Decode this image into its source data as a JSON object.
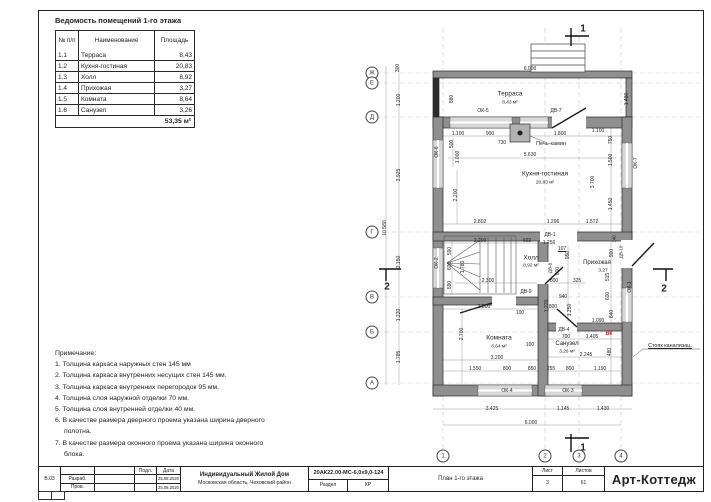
{
  "room_table": {
    "title": "Ведомость помещений 1-го этажа",
    "headers": [
      "№ п/п",
      "Наименование",
      "Площадь"
    ],
    "rows": [
      [
        "1.1",
        "Терраса",
        "8,43"
      ],
      [
        "1.2",
        "Кухня-гостиная",
        "20,83"
      ],
      [
        "1.3",
        "Холл",
        "8,92"
      ],
      [
        "1.4",
        "Прихожая",
        "3,27"
      ],
      [
        "1.5",
        "Комната",
        "8,64"
      ],
      [
        "1.6",
        "Санузел",
        "3,26"
      ]
    ],
    "total": "53,35 м²"
  },
  "notes": {
    "title": "Примечание:",
    "items": [
      "1. Толщина каркаса наружных стен 145 мм",
      "2. Толщина каркаса внутренних несущих стен 145 мм.",
      "3. Толщина каркаса внутренних перегородок 95 мм.",
      "4. Толщина слоя наружной отделки 70 мм.",
      "5. Толщина слоя внутренней отделки 40 мм.",
      "6. В качестве размера дверного проема указана ширина дверного полотна.",
      "7. В качестве размера оконного проема указана ширина оконного блока."
    ]
  },
  "title_block": {
    "rev": "В.03",
    "razrab_label": "Разраб.",
    "prov_label": "Пров.",
    "podl_label": "Подл.",
    "date_label": "Дата",
    "date1": "25.08.2020",
    "date2": "25.08.2020",
    "project": "Индивидуальный Жилой Дом",
    "location": "Московская область, Чеховский район",
    "doc_code": "20АК22.00-МС-6,0х9,0-124",
    "razdel_label": "Раздел",
    "razdel_value": "КР",
    "sheet_name": "План 1-го этажа",
    "sheet_label": "Лист",
    "sheets_label": "Листов",
    "sheet_num": "3",
    "sheets_total": "61",
    "company": "Арт-Коттедж"
  },
  "plan": {
    "accent_red": "#cc2222",
    "axis_bubbles_bottom": [
      {
        "label": "1",
        "x": 443
      },
      {
        "label": "2",
        "x": 545
      },
      {
        "label": "3",
        "x": 579
      },
      {
        "label": "4",
        "x": 621
      }
    ],
    "axis_bubbles_left": [
      {
        "label": "Ж",
        "y": 73
      },
      {
        "label": "Е",
        "y": 83
      },
      {
        "label": "Д",
        "y": 117
      },
      {
        "label": "Г",
        "y": 232
      },
      {
        "label": "В",
        "y": 297
      },
      {
        "label": "Б",
        "y": 332
      },
      {
        "label": "А",
        "y": 383
      }
    ],
    "labels": [
      {
        "t": "6.000",
        "x": 530,
        "y": 69
      },
      {
        "t": "1.480",
        "x": 627,
        "y": 99,
        "r": -90
      },
      {
        "t": "880",
        "x": 452,
        "y": 99,
        "r": -90
      },
      {
        "t": "Терраса",
        "x": 510,
        "y": 94,
        "s": 6.5,
        "n": "room-label"
      },
      {
        "t": "8,43 м²",
        "x": 510,
        "y": 103,
        "s": 4.8,
        "n": "room-area"
      },
      {
        "t": "ОК-5",
        "x": 483,
        "y": 111,
        "n": "opening-mark"
      },
      {
        "t": "ДВ-7",
        "x": 556,
        "y": 111,
        "n": "opening-mark"
      },
      {
        "t": "1.100",
        "x": 458,
        "y": 134
      },
      {
        "t": "900",
        "x": 490,
        "y": 134
      },
      {
        "t": "1.800",
        "x": 560,
        "y": 134
      },
      {
        "t": "1.100",
        "x": 598,
        "y": 131
      },
      {
        "t": "750",
        "x": 611,
        "y": 140,
        "r": -90
      },
      {
        "t": "500",
        "x": 452,
        "y": 144,
        "r": -90
      },
      {
        "t": "1.000",
        "x": 458,
        "y": 157,
        "r": -90
      },
      {
        "t": "730",
        "x": 502,
        "y": 143
      },
      {
        "t": "Печь-камин",
        "x": 551,
        "y": 144,
        "s": 5.5,
        "n": "stove-label"
      },
      {
        "t": "5.630",
        "x": 530,
        "y": 155
      },
      {
        "t": "ОК-6",
        "x": 437,
        "y": 152,
        "r": -90,
        "n": "opening-mark"
      },
      {
        "t": "ОК-7",
        "x": 636,
        "y": 163,
        "r": -90,
        "n": "opening-mark"
      },
      {
        "t": "Кухня-гостиная",
        "x": 545,
        "y": 174,
        "s": 6.5,
        "n": "room-label"
      },
      {
        "t": "20,83 м²",
        "x": 545,
        "y": 183,
        "s": 4.8,
        "n": "room-area"
      },
      {
        "t": "1.500",
        "x": 611,
        "y": 160,
        "r": -90
      },
      {
        "t": "3.700",
        "x": 593,
        "y": 182,
        "r": -90
      },
      {
        "t": "1.450",
        "x": 611,
        "y": 204,
        "r": -90
      },
      {
        "t": "2.200",
        "x": 456,
        "y": 195,
        "r": -90
      },
      {
        "t": "2.802",
        "x": 480,
        "y": 222
      },
      {
        "t": "1.296",
        "x": 553,
        "y": 222
      },
      {
        "t": "1.572",
        "x": 592,
        "y": 222
      },
      {
        "t": "ДВ-1",
        "x": 550,
        "y": 235,
        "n": "opening-mark"
      },
      {
        "t": "1.256",
        "x": 549,
        "y": 243
      },
      {
        "t": "2.200",
        "x": 480,
        "y": 241
      },
      {
        "t": "602",
        "x": 527,
        "y": 241
      },
      {
        "t": "107",
        "x": 562,
        "y": 249,
        "u": true
      },
      {
        "t": "Холл",
        "x": 531,
        "y": 258,
        "s": 6.5,
        "n": "room-label"
      },
      {
        "t": "8,92 м²",
        "x": 531,
        "y": 266,
        "s": 4.8,
        "n": "room-area"
      },
      {
        "t": "Прихожая",
        "x": 597,
        "y": 263,
        "s": 6,
        "n": "room-label"
      },
      {
        "t": "3,27",
        "x": 603,
        "y": 271,
        "s": 4.8,
        "n": "room-area"
      },
      {
        "t": "950",
        "x": 568,
        "y": 255,
        "r": -90
      },
      {
        "t": "900",
        "x": 612,
        "y": 253,
        "r": -90
      },
      {
        "t": "ДВ-10",
        "x": 621,
        "y": 252,
        "r": -90,
        "s": 4.6,
        "n": "opening-mark"
      },
      {
        "t": "140",
        "x": 614,
        "y": 239,
        "r": -90,
        "s": 4.4
      },
      {
        "t": "ДВ-8",
        "x": 550,
        "y": 268,
        "r": -90,
        "s": 4.6,
        "n": "opening-mark"
      },
      {
        "t": "800",
        "x": 558,
        "y": 271,
        "r": -90
      },
      {
        "t": "515",
        "x": 608,
        "y": 277,
        "r": -90
      },
      {
        "t": "ОК-1",
        "x": 630,
        "y": 287,
        "r": -90,
        "n": "opening-mark"
      },
      {
        "t": "600",
        "x": 608,
        "y": 296,
        "r": -90
      },
      {
        "t": "590",
        "x": 450,
        "y": 251,
        "r": -90
      },
      {
        "t": "600",
        "x": 450,
        "y": 266,
        "r": -90
      },
      {
        "t": "1.780",
        "x": 463,
        "y": 267,
        "r": -90
      },
      {
        "t": "590",
        "x": 450,
        "y": 285,
        "r": -90
      },
      {
        "t": "2.300",
        "x": 488,
        "y": 281
      },
      {
        "t": "800",
        "x": 554,
        "y": 281
      },
      {
        "t": "325",
        "x": 577,
        "y": 281
      },
      {
        "t": "ДВ-9",
        "x": 526,
        "y": 292,
        "n": "opening-mark"
      },
      {
        "t": "940",
        "x": 563,
        "y": 297
      },
      {
        "t": "2.300",
        "x": 484,
        "y": 307
      },
      {
        "t": "800",
        "x": 553,
        "y": 307
      },
      {
        "t": "100",
        "x": 520,
        "y": 313
      },
      {
        "t": "1.220",
        "x": 547,
        "y": 306,
        "r": -90
      },
      {
        "t": "1.250",
        "x": 570,
        "y": 310,
        "r": -90
      },
      {
        "t": "840",
        "x": 612,
        "y": 314,
        "r": -90
      },
      {
        "t": "1.090",
        "x": 598,
        "y": 321
      },
      {
        "t": "ОК-2",
        "x": 437,
        "y": 263,
        "r": -90,
        "n": "opening-mark"
      },
      {
        "t": "ДВ-4",
        "x": 564,
        "y": 330,
        "n": "opening-mark"
      },
      {
        "t": "700",
        "x": 566,
        "y": 337
      },
      {
        "t": "1.405",
        "x": 592,
        "y": 337
      },
      {
        "t": "ВК",
        "x": 609,
        "y": 334,
        "c": "#cc2222",
        "w": true,
        "s": 5.2,
        "n": "vk-mark"
      },
      {
        "t": "2.700",
        "x": 462,
        "y": 334,
        "r": -90
      },
      {
        "t": "Комната",
        "x": 499,
        "y": 338,
        "s": 6.5,
        "n": "room-label"
      },
      {
        "t": "8,64 м²",
        "x": 499,
        "y": 347,
        "s": 4.8,
        "n": "room-area"
      },
      {
        "t": "100",
        "x": 530,
        "y": 345
      },
      {
        "t": "Санузел",
        "x": 567,
        "y": 344,
        "s": 6,
        "n": "room-label"
      },
      {
        "t": "3,26 м²",
        "x": 567,
        "y": 352,
        "s": 4.8,
        "n": "room-area"
      },
      {
        "t": "2.245",
        "x": 586,
        "y": 355
      },
      {
        "t": "480",
        "x": 610,
        "y": 352,
        "r": -90
      },
      {
        "t": "3.200",
        "x": 497,
        "y": 358
      },
      {
        "t": "Стояк канализац.",
        "x": 670,
        "y": 346,
        "s": 5.4,
        "u": true,
        "n": "sewer-riser-label"
      },
      {
        "t": "1.550",
        "x": 475,
        "y": 369
      },
      {
        "t": "800",
        "x": 507,
        "y": 369
      },
      {
        "t": "850",
        "x": 532,
        "y": 369
      },
      {
        "t": "255",
        "x": 551,
        "y": 369
      },
      {
        "t": "800",
        "x": 570,
        "y": 369
      },
      {
        "t": "1.190",
        "x": 600,
        "y": 369
      },
      {
        "t": "ОК-4",
        "x": 507,
        "y": 391,
        "n": "opening-mark"
      },
      {
        "t": "ОК-3",
        "x": 568,
        "y": 391,
        "n": "opening-mark"
      },
      {
        "t": "3.425",
        "x": 492,
        "y": 409
      },
      {
        "t": "1.145",
        "x": 563,
        "y": 409
      },
      {
        "t": "1.430",
        "x": 603,
        "y": 409
      },
      {
        "t": "6.000",
        "x": 531,
        "y": 423
      },
      {
        "t": "300",
        "x": 398,
        "y": 68,
        "r": -90
      },
      {
        "t": "1.200",
        "x": 399,
        "y": 100,
        "r": -90
      },
      {
        "t": "3.925",
        "x": 399,
        "y": 175,
        "r": -90
      },
      {
        "t": "10.580",
        "x": 385,
        "y": 228,
        "r": -90
      },
      {
        "t": "2.150",
        "x": 399,
        "y": 262,
        "r": -90
      },
      {
        "t": "1.220",
        "x": 399,
        "y": 315,
        "r": -90
      },
      {
        "t": "1.785",
        "x": 399,
        "y": 357,
        "r": -90
      },
      {
        "t": "1",
        "x": 583,
        "y": 29,
        "w": true,
        "s": 10,
        "n": "section-number"
      },
      {
        "t": "1",
        "x": 583,
        "y": 448,
        "w": true,
        "s": 10,
        "n": "section-number"
      },
      {
        "t": "2",
        "x": 387,
        "y": 287,
        "w": true,
        "s": 10,
        "n": "section-number"
      },
      {
        "t": "2",
        "x": 664,
        "y": 289,
        "w": true,
        "s": 10,
        "n": "section-number"
      }
    ]
  }
}
